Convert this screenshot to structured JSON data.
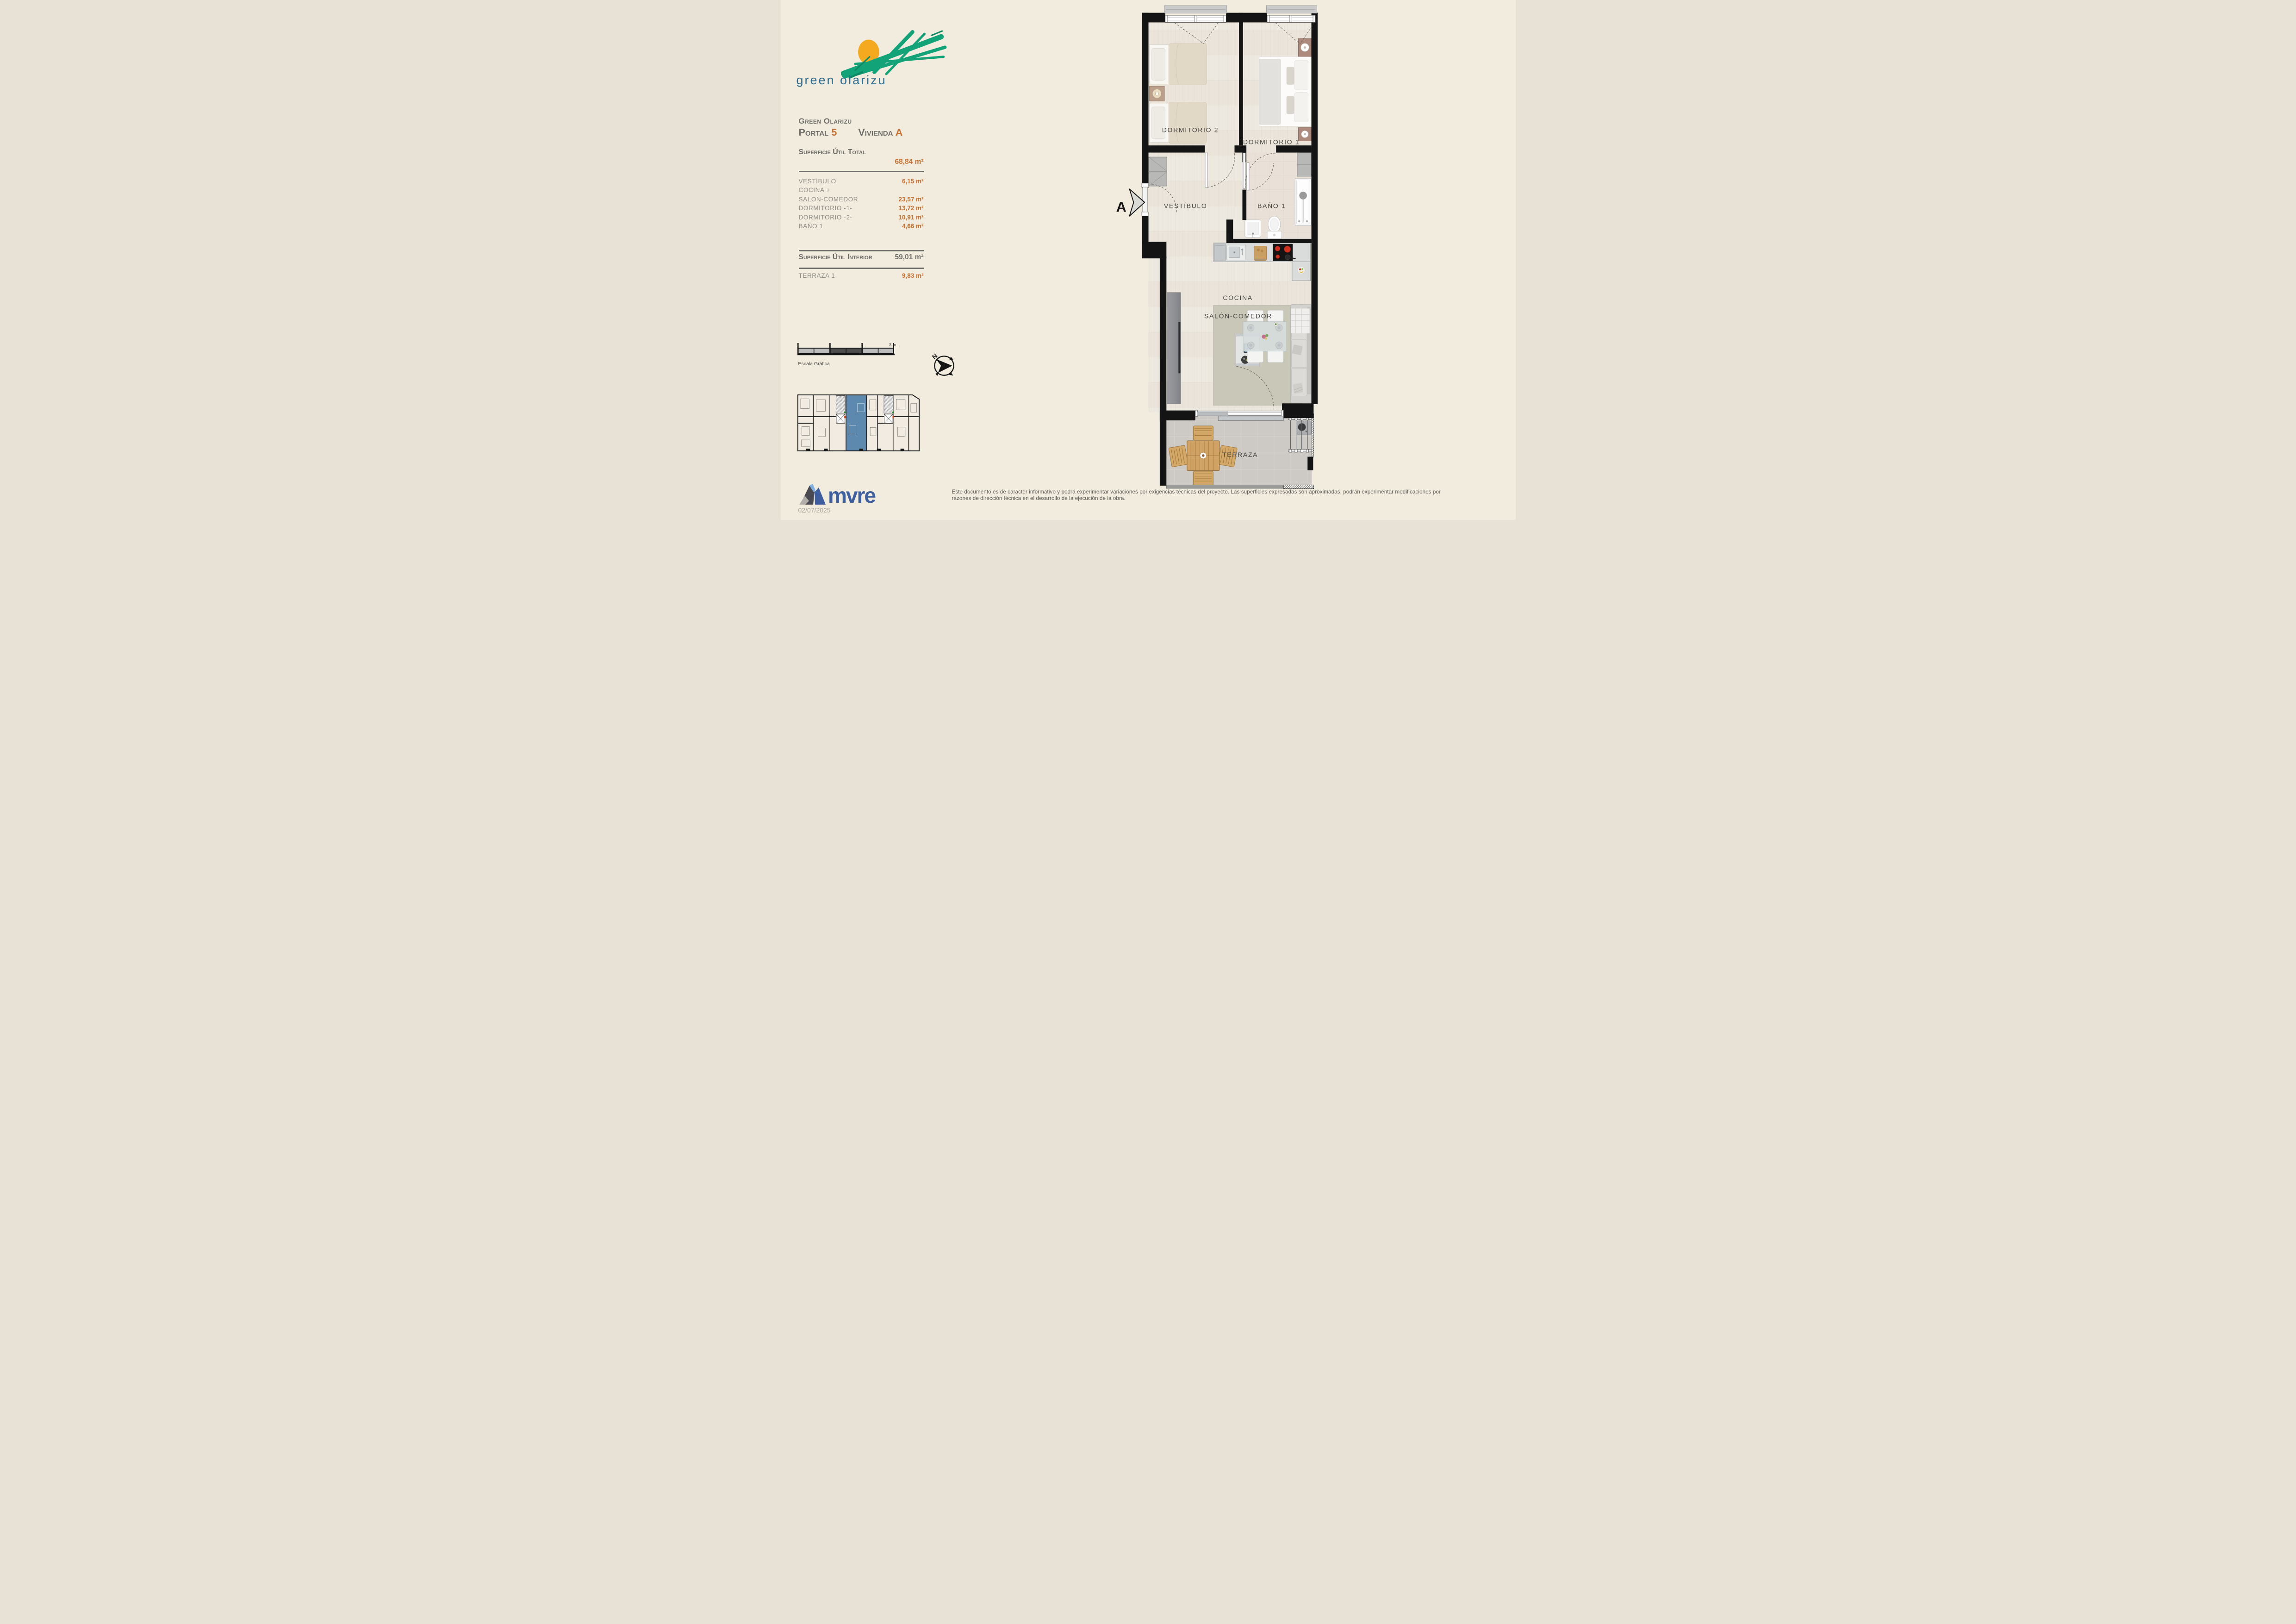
{
  "brand": {
    "logo_text": "green olarizu"
  },
  "header": {
    "project": "Green Olarizu",
    "portal_label": "Portal",
    "portal_value": "5",
    "vivienda_label": "Vivienda",
    "vivienda_value": "A"
  },
  "areas": {
    "total_label": "Superficie Útil Total",
    "total_value": "68,84 m²",
    "rows": [
      {
        "label": "VESTÍBULO",
        "value": "6,15 m²"
      },
      {
        "label": "COCINA +",
        "value": ""
      },
      {
        "label": "SALON-COMEDOR",
        "value": "23,57 m²"
      },
      {
        "label": "DORMITORIO -1-",
        "value": "13,72 m²"
      },
      {
        "label": "DORMITORIO -2-",
        "value": "10,91 m²"
      },
      {
        "label": "BAÑO 1",
        "value": "4,66 m²"
      }
    ],
    "interior_label": "Superficie Útil Interior",
    "interior_value": "59,01 m²",
    "terraza_label": "TERRAZA 1",
    "terraza_value": "9,83 m²"
  },
  "scale_bar": {
    "tick1": "1",
    "tick2": "2",
    "tick3": "3 m.",
    "caption": "Escala Gráfica"
  },
  "compass": {
    "north": "N"
  },
  "plan": {
    "section_marker": "A",
    "rooms": {
      "dorm2": "DORMITORIO 2",
      "dorm1": "DORMITORIO 1",
      "vestibulo": "VESTÍBULO",
      "bano": "BAÑO 1",
      "cocina": "COCINA",
      "salon": "SALÓN-COMEDOR",
      "terraza": "TERRAZA"
    }
  },
  "footer": {
    "company": "mvre",
    "date": "02/07/2025",
    "disclaimer_line1": "Este documento es de caracter informativo y podrá experimentar variaciones por exigencias técnicas del proyecto. Las superficies expresadas son aproximadas, podrán experimentar modificaciones por",
    "disclaimer_line2": "razones de dirección técnica en el desarrollo de la ejecución de la obra."
  },
  "colors": {
    "accent_orange": "#c7702f",
    "logo_green": "#12a378",
    "logo_teal": "#2e6d92",
    "sun_orange": "#f5a91e",
    "highlight_blue": "#5d89ae",
    "mvre_navy": "#3d5f9f",
    "wall_black": "#141414"
  }
}
